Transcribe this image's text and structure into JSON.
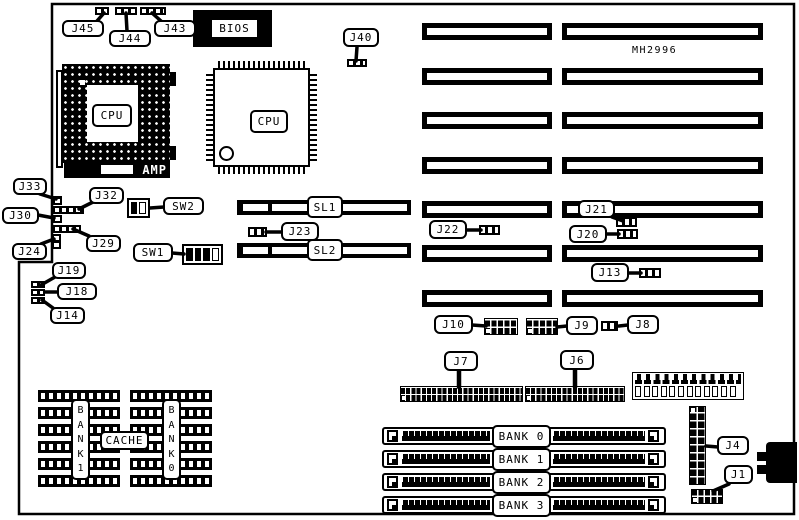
{
  "board": {
    "model": "MH2996"
  },
  "chips": {
    "bios_label": "BIOS",
    "cpu_socket_label": "CPU",
    "cpu_qfp_label": "CPU",
    "amp_label": "AMP"
  },
  "labels": {
    "j45": "J45",
    "j44": "J44",
    "j43": "J43",
    "j40": "J40",
    "j33": "J33",
    "j32": "J32",
    "j30": "J30",
    "j29": "J29",
    "j24": "J24",
    "j19": "J19",
    "j18": "J18",
    "j14": "J14",
    "sw2": "SW2",
    "sw1": "SW1",
    "j23": "J23",
    "j22": "J22",
    "j21": "J21",
    "j20": "J20",
    "j13": "J13",
    "j10": "J10",
    "j9": "J9",
    "j8": "J8",
    "j7": "J7",
    "j6": "J6",
    "j4": "J4",
    "j1": "J1"
  },
  "slots": {
    "sl1": "SL1",
    "sl2": "SL2"
  },
  "memory": {
    "banks": [
      "BANK 0",
      "BANK 1",
      "BANK 2",
      "BANK 3"
    ]
  },
  "cache": {
    "label": "CACHE",
    "bank1_vertical": "B\nA\nN\nK\n1",
    "bank0_vertical": "B\nA\nN\nK\n0"
  }
}
